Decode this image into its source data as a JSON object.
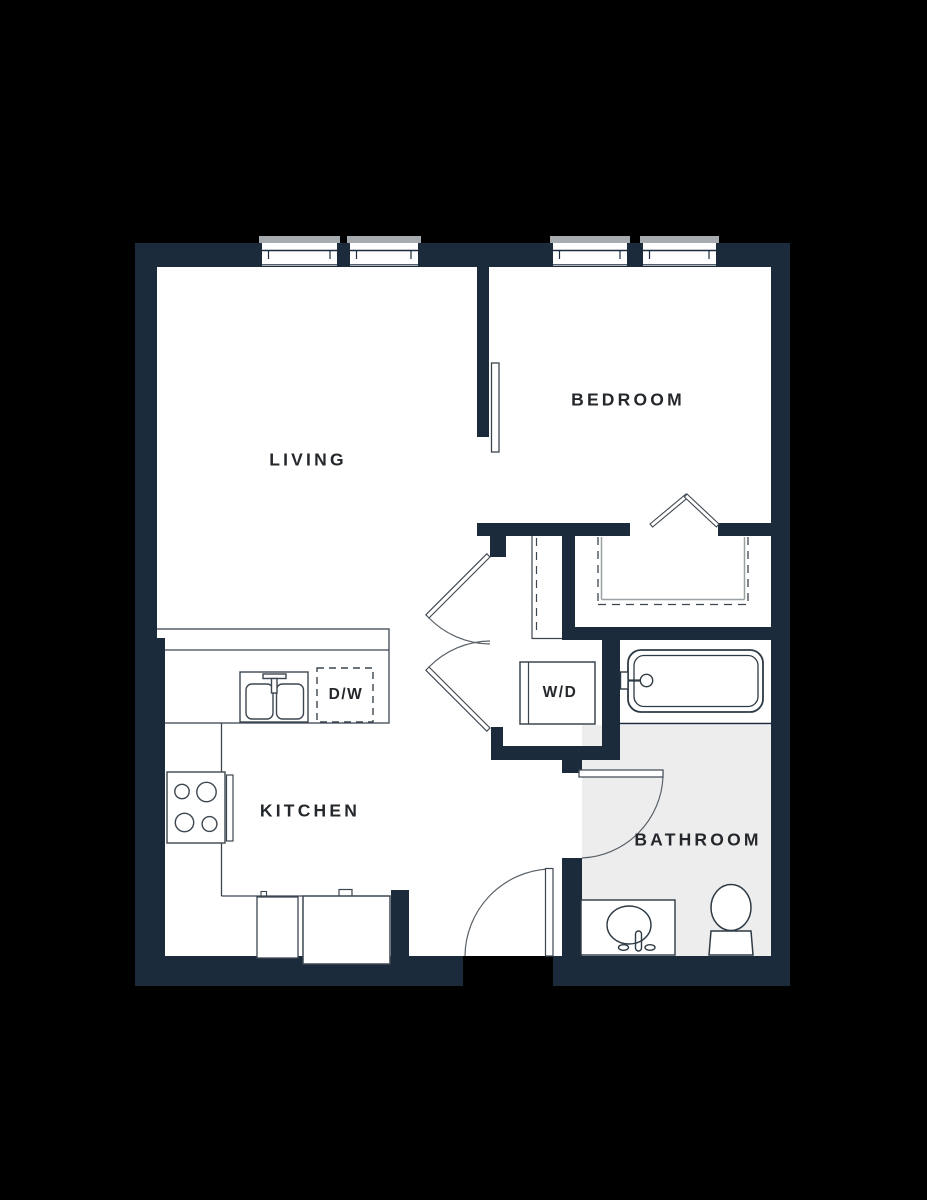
{
  "plan": {
    "title": "one-bedroom apartment floor plan",
    "rooms": [
      {
        "id": "living",
        "label": "LIVING"
      },
      {
        "id": "bedroom",
        "label": "BEDROOM"
      },
      {
        "id": "kitchen",
        "label": "KITCHEN"
      },
      {
        "id": "bathroom",
        "label": "BATHROOM"
      }
    ],
    "appliances": [
      {
        "id": "washer-dryer",
        "label": "W/D"
      },
      {
        "id": "dishwasher",
        "label": "D/W"
      }
    ],
    "fixtures": [
      "bathtub",
      "toilet",
      "vanity-sink",
      "kitchen-sink",
      "stove",
      "refrigerator",
      "base-cabinet",
      "closet-rods"
    ],
    "doors": [
      "entry-swing-door",
      "bathroom-swing-door",
      "living-double-doors",
      "bedroom-closet-bifold-doors",
      "bedroom-sliding-door"
    ],
    "windows_count": 4,
    "colors": {
      "background": "#000000",
      "wall": "#1b2b3b",
      "floor": "#ffffff",
      "bathroom_floor": "#ededee",
      "window_sill": "#a6abaf",
      "label_text": "#24272b",
      "arc_line": "#5a6268",
      "closet_line": "#9aa0a4"
    }
  }
}
